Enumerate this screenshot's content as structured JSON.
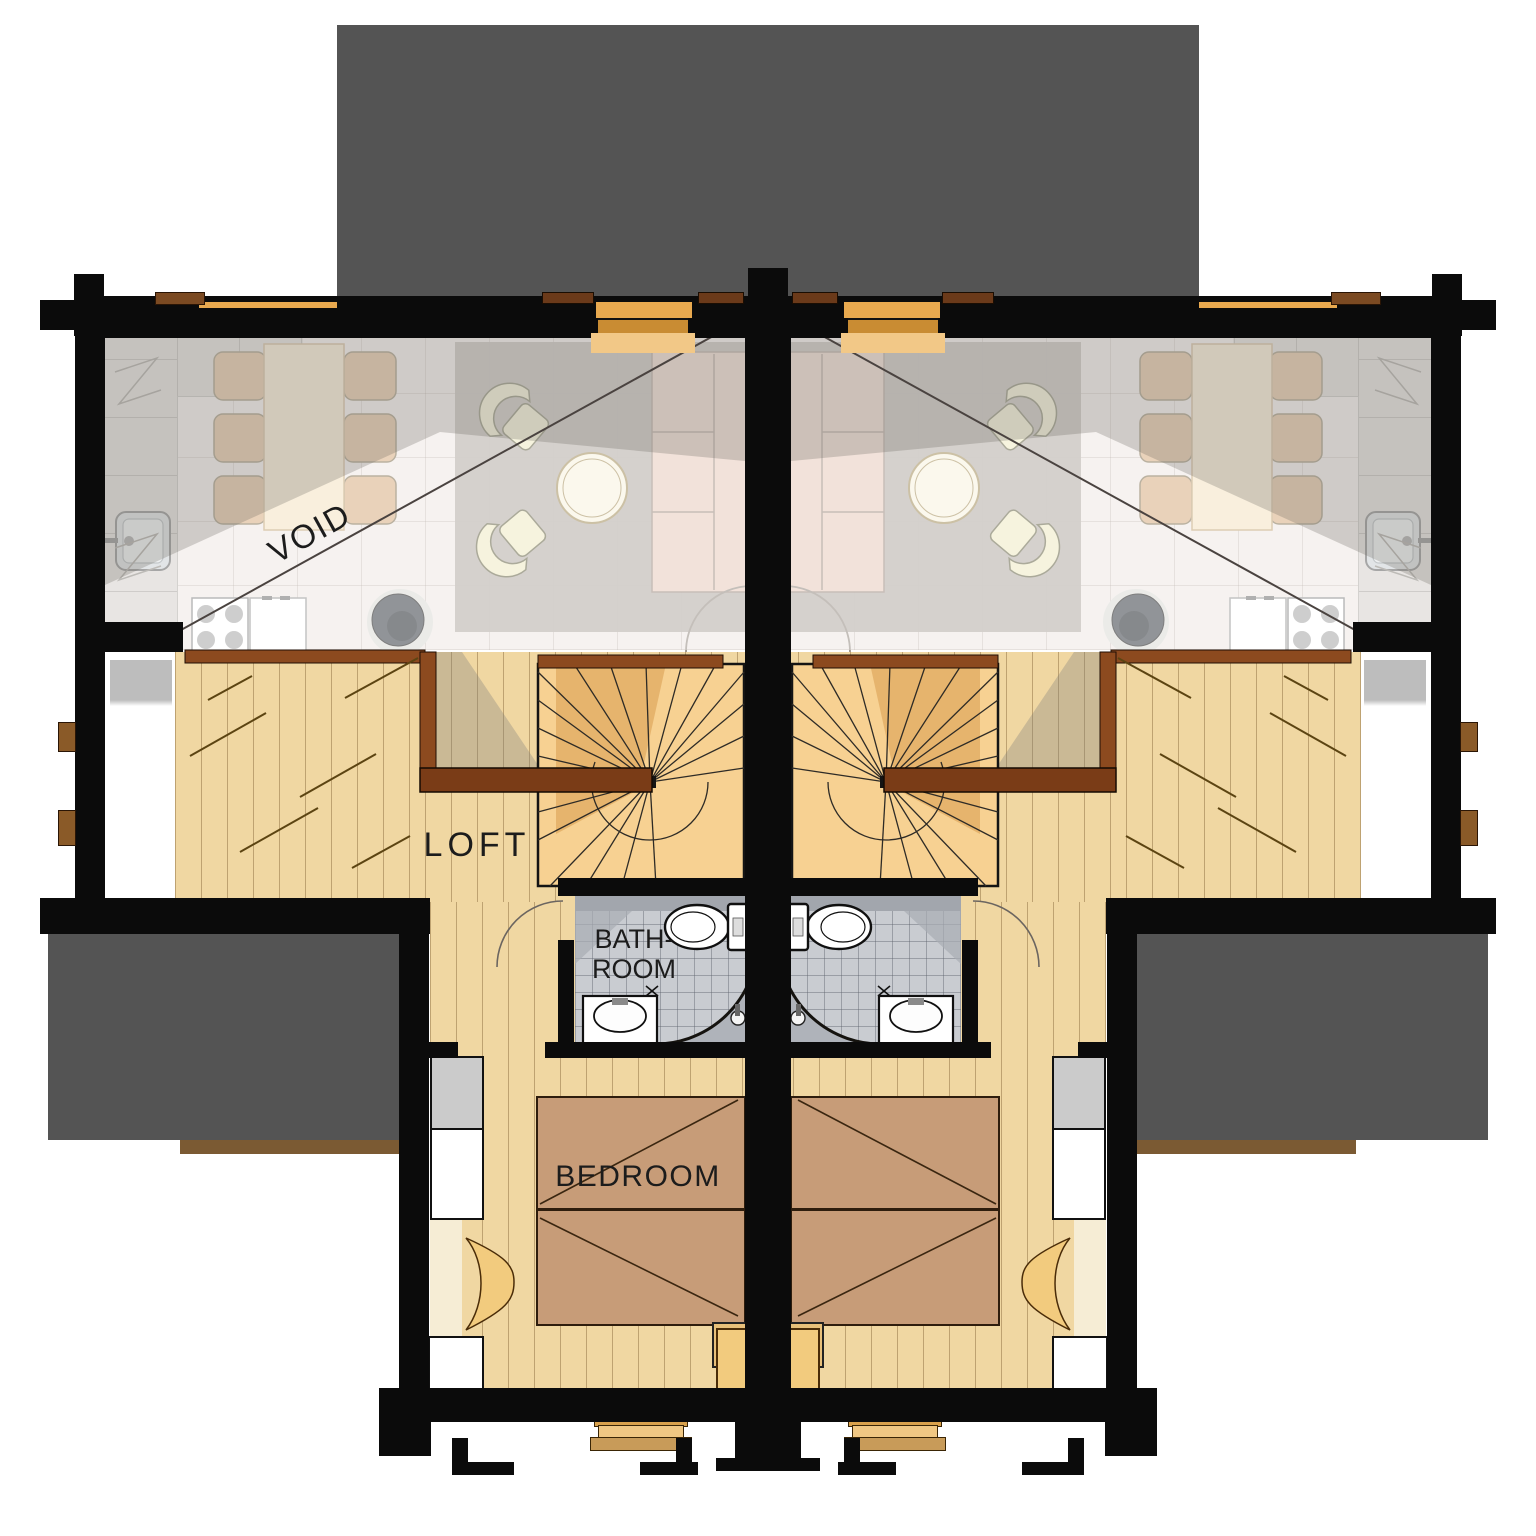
{
  "plan": {
    "type": "floor-plan",
    "units": [
      {
        "id": "left",
        "rooms": {
          "void": "VOID",
          "loft": "LOFT",
          "bath": "BATH-\nROOM",
          "bedroom": "BEDROOM"
        }
      },
      {
        "id": "right",
        "rooms": {
          "void": "VOID",
          "loft": "LOFT",
          "bath": "BATH-\nROOM",
          "bedroom": "BEDROOM"
        }
      }
    ]
  },
  "colors": {
    "roof": "#545454",
    "wall": "#0B0B0B",
    "wood": "#F0D7A2",
    "stair": "#F7D192",
    "stair_shade": "#E3AF66",
    "rail": "#8C4A1F",
    "rail_dark": "#7A3C17",
    "tile": "#C9CCD1",
    "bed": "#C79C78",
    "rug": "#B3ADA7",
    "sofa": "#E9CDC0",
    "armchair": "#EFEBC6",
    "table": "#F5E3C4",
    "chair": "#D9B289",
    "gold": "#E8A94F",
    "gold_light": "#F2C887",
    "gold_dark": "#C98C33",
    "door": "#F2CB7E",
    "void_floor": "#EFE9E6",
    "counter": "#D7D3CF",
    "stove": "#43484E",
    "deck": "#7B5A33",
    "ink": "#1C1C1C"
  }
}
